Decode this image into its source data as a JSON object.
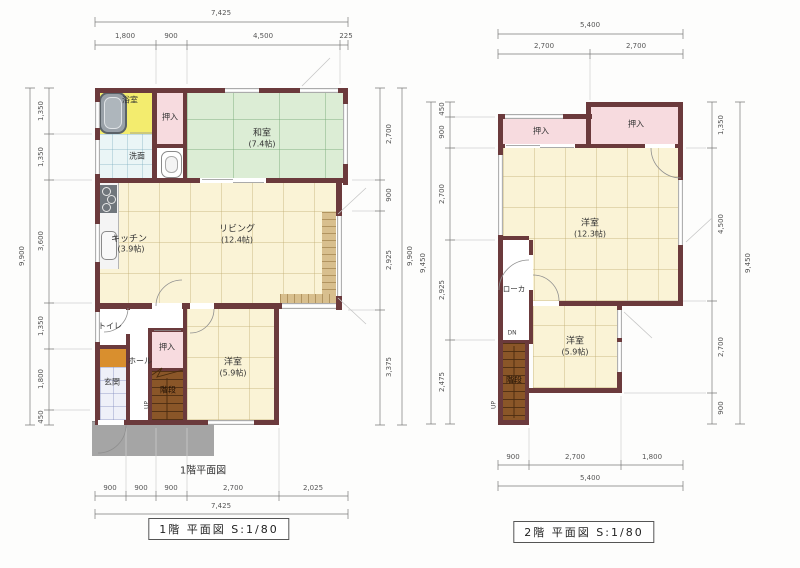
{
  "colors": {
    "wall": "#6b3a3c",
    "tatami_floor": "#dcedd5",
    "wood_floor": "#faf3d6",
    "closet": "#f7dbdf",
    "bathroom": "#f3ec6e",
    "stairs": "#8a5628",
    "genkan": "#d98f2e",
    "porch": "#a5a5a5",
    "veranda": "#d8bf8e"
  },
  "floor1": {
    "plan_label": "1階平面図",
    "caption": "1階 平面図 S:1/80",
    "dims": {
      "top_total": "7,425",
      "top": [
        "1,800",
        "900",
        "4,500",
        "225"
      ],
      "bottom": [
        "900",
        "900",
        "900",
        "2,700",
        "2,025"
      ],
      "bottom_total": "7,425",
      "left": [
        "1,350",
        "1,350",
        "3,600",
        "1,350",
        "1,800",
        "450"
      ],
      "left_total": "9,900",
      "right": [
        "2,700",
        "900",
        "2,925",
        "3,375"
      ],
      "right_total": "9,900"
    },
    "rooms": {
      "bath": "浴室",
      "washroom": "洗面",
      "closet_top": "押入",
      "washitsu_name": "和室",
      "washitsu_size": "(7.4帖)",
      "kitchen_name": "キッチン",
      "kitchen_size": "(3.9帖)",
      "living_name": "リビング",
      "living_size": "(12.4帖)",
      "toilet": "トイレ",
      "hall": "ホール",
      "genkan": "玄関",
      "closet_bottom": "押入",
      "stairs": "階段",
      "stairs_up": "UP",
      "bedroom_name": "洋室",
      "bedroom_size": "(5.9帖)"
    }
  },
  "floor2": {
    "caption": "2階 平面図 S:1/80",
    "dims": {
      "top_total": "5,400",
      "top": [
        "2,700",
        "2,700"
      ],
      "bottom": [
        "900",
        "2,700",
        "1,800"
      ],
      "bottom_total": "5,400",
      "left": [
        "450",
        "900",
        "2,700",
        "2,925",
        "2,475"
      ],
      "left_total": "9,450",
      "right": [
        "1,350",
        "4,500",
        "2,700",
        "900"
      ],
      "right_total": "9,450"
    },
    "rooms": {
      "closet_left": "押入",
      "closet_right": "押入",
      "bedroom_large_name": "洋室",
      "bedroom_large_size": "(12.3帖)",
      "corridor": "ローカ",
      "stairs": "階段",
      "stairs_dn": "DN",
      "stairs_up": "UP",
      "bedroom_small_name": "洋室",
      "bedroom_small_size": "(5.9帖)"
    }
  }
}
